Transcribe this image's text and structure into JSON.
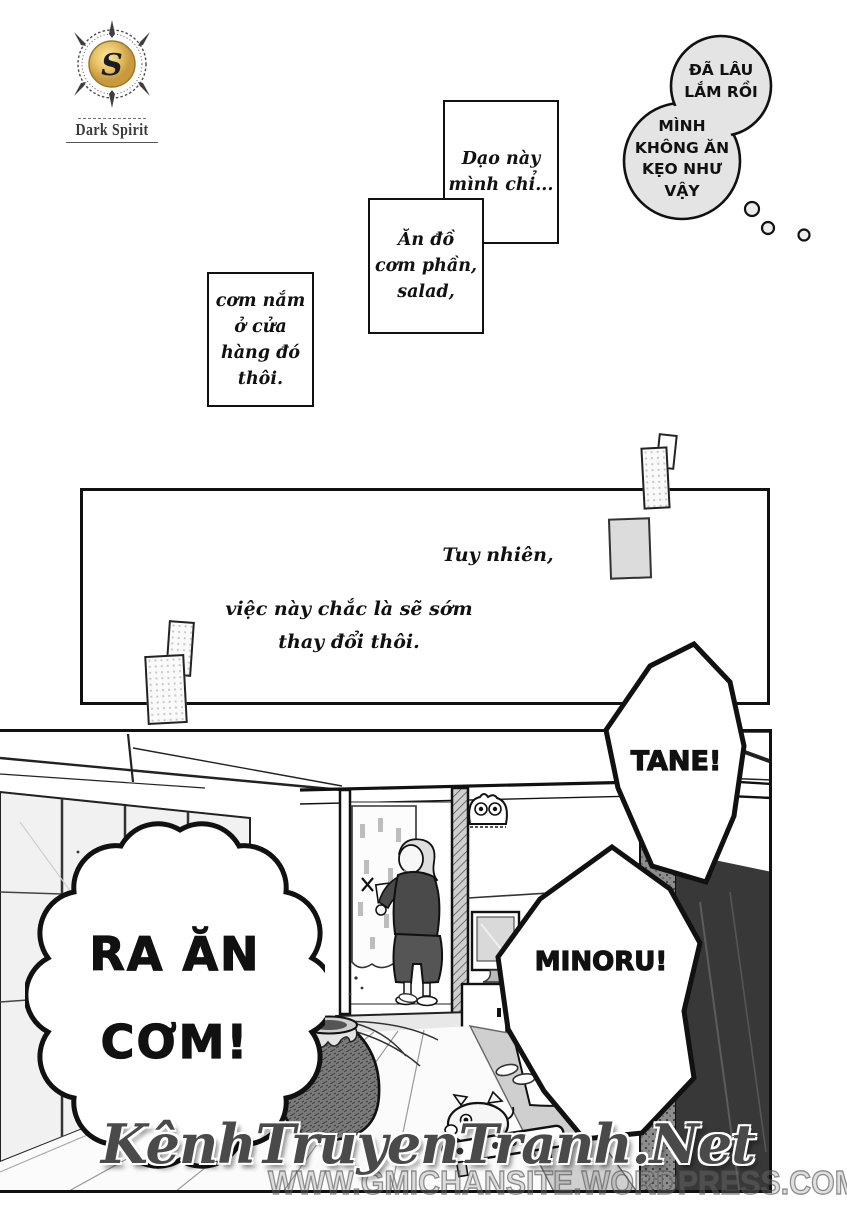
{
  "logo": {
    "initial": "S",
    "name": "Dark Spirit"
  },
  "thought_bubble": {
    "top_lines": [
      "ĐÃ LÂU",
      "LẮM RỒI"
    ],
    "bottom_lines": [
      "MÌNH",
      "KHÔNG ĂN",
      "KẸO NHƯ",
      "VẬY"
    ]
  },
  "captions": [
    {
      "lines": [
        "Dạo này",
        "mình chỉ..."
      ]
    },
    {
      "lines": [
        "Ăn đồ",
        "cơm phần,",
        "salad,"
      ]
    },
    {
      "lines": [
        "cơm nắm",
        "ở cửa",
        "hàng đó",
        "thôi."
      ]
    }
  ],
  "panel2": {
    "caption_right": "Tuy nhiên,",
    "caption_center_lines": [
      "việc này chắc là sẽ sớm",
      "thay đổi thôi."
    ]
  },
  "bubbles": {
    "tane": "TANE!",
    "minoru": "MINORU!",
    "shout_lines": [
      "RA ĂN",
      "CƠM!"
    ]
  },
  "watermark": {
    "site_name": "KênhTruyenTranh.Net",
    "site_url": "WWW.GMICHANSITE.WORDPRESS.COM"
  },
  "colors": {
    "ink": "#111111",
    "thought_fill": "#e4e4e4",
    "note_fill": "#dcdcdc",
    "logo_gold": "#e9c468",
    "pane_gray": "#f1f1f1",
    "dark_drape": "#383838"
  }
}
